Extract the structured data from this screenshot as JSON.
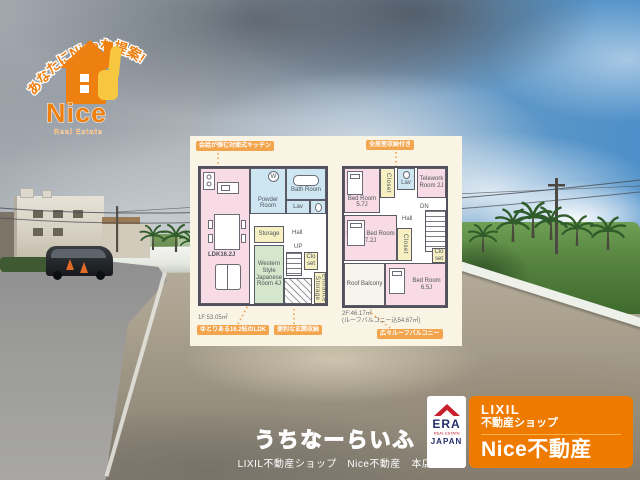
{
  "logo": {
    "arc_tagline": "あなたにNiceな提案!",
    "name": "Nice",
    "subtitle": "Real Estate"
  },
  "floorplan": {
    "badges": {
      "kitchen": "会話が弾む対面式キッチン",
      "all_rooms_storage": "全居室収納付き",
      "ldk": "ゆとりある16.2帖のLDK",
      "entrance_storage": "便利な玄関収納",
      "roof_balcony": "広々ルーフバルコニー"
    },
    "floor1": {
      "area": "1F:53.05㎡",
      "washer_mark": "W",
      "rooms": {
        "ldk": "LDK16.2J",
        "powder_room": "Powder Room",
        "bath_room": "Bath Room",
        "lav": "Lav",
        "storage": "Storage",
        "western_japanese_room": "Western Style Japanese Room 4J",
        "hall": "Hall",
        "up": "UP",
        "closet": "Clo set",
        "entrance_storage": "Entrance Storage"
      }
    },
    "floor2": {
      "area": "2F:46.17㎡",
      "area_note": "(ルーフバルコニー込54.67㎡)",
      "rooms": {
        "bed1": "Bed Room 5.7J",
        "closet1": "Closet",
        "lav": "Lav",
        "telework": "Telework Room 2J",
        "dn": "DN",
        "hall": "Hall",
        "master": "Master Bed Room 7.2J",
        "closet2": "Closet",
        "closet3": "Clo set",
        "roof_balcony": "Roof Balcony",
        "bed2": "Bed Room 6.5J"
      }
    }
  },
  "era_badge": {
    "name": "ERA",
    "subtitle": "REAL ESTATE",
    "region": "JAPAN"
  },
  "shop_badge": {
    "brand": "LIXIL",
    "brand_line2": "不動産ショップ",
    "shop_name": "Nice不動産"
  },
  "footer": {
    "site": "うちなーらいふ",
    "store": "LIXIL不動産ショップ　Nice不動産　本店"
  },
  "colors": {
    "brand_orange": "#ee7f11",
    "badge_orange": "#f3a54e",
    "room_pink": "#f8dbe4",
    "room_blue": "#cde6f2",
    "room_green": "#d4e6cc",
    "room_yellow": "#f6f0c2",
    "era_red": "#c8202f",
    "era_navy": "#23306b"
  }
}
